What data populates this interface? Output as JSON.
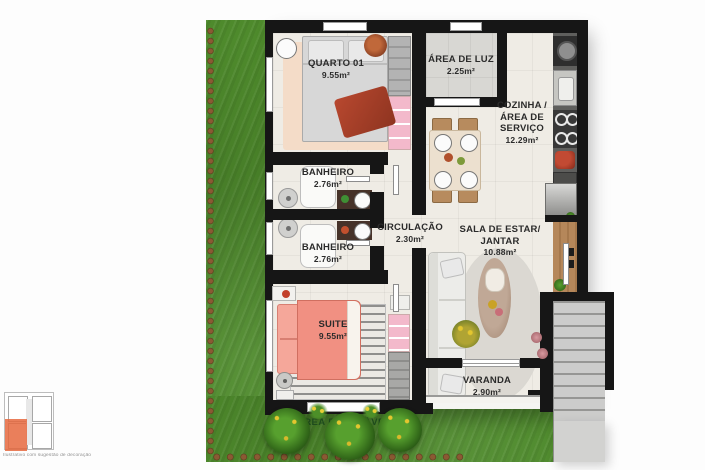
{
  "plan": {
    "rooms": {
      "quarto01": {
        "label": "QUARTO 01",
        "area": "9.55m²"
      },
      "area_de_luz": {
        "label": "ÁREA DE LUZ",
        "area": "2.25m²"
      },
      "cozinha": {
        "line1": "COZINHA /",
        "line2": "ÁREA DE",
        "line3": "SERVIÇO",
        "area": "12.29m²"
      },
      "banheiro1": {
        "label": "BANHEIRO",
        "area": "2.76m²"
      },
      "banheiro2": {
        "label": "BANHEIRO",
        "area": "2.76m²"
      },
      "circulacao": {
        "label": "CIRCULAÇÃO",
        "area": "2.30m²"
      },
      "sala": {
        "line1": "SALA DE ESTAR/",
        "line2": "JANTAR",
        "area": "10.88m²"
      },
      "suite": {
        "label": "SUITE",
        "area": "9.55m²"
      },
      "varanda": {
        "label": "VARANDA",
        "area": "2.90m²"
      }
    },
    "garden": {
      "label": "ÁREA PERMEÁVEL"
    },
    "inset": {
      "caption": "Ilustrativo com sugestão de decoração"
    },
    "colors": {
      "wall": "#161616",
      "floor": "#efece5",
      "grass": "#4e8a2c",
      "light_area_floor": "#d8d7d3",
      "suite_bed": "#f19082",
      "wardrobe_pink": "#f3b9cb",
      "wood": "#b5875a",
      "highlight_unit": "#e6693e",
      "label_text": "#2b2b2b",
      "garden_label_text": "#1f4c1d"
    }
  }
}
